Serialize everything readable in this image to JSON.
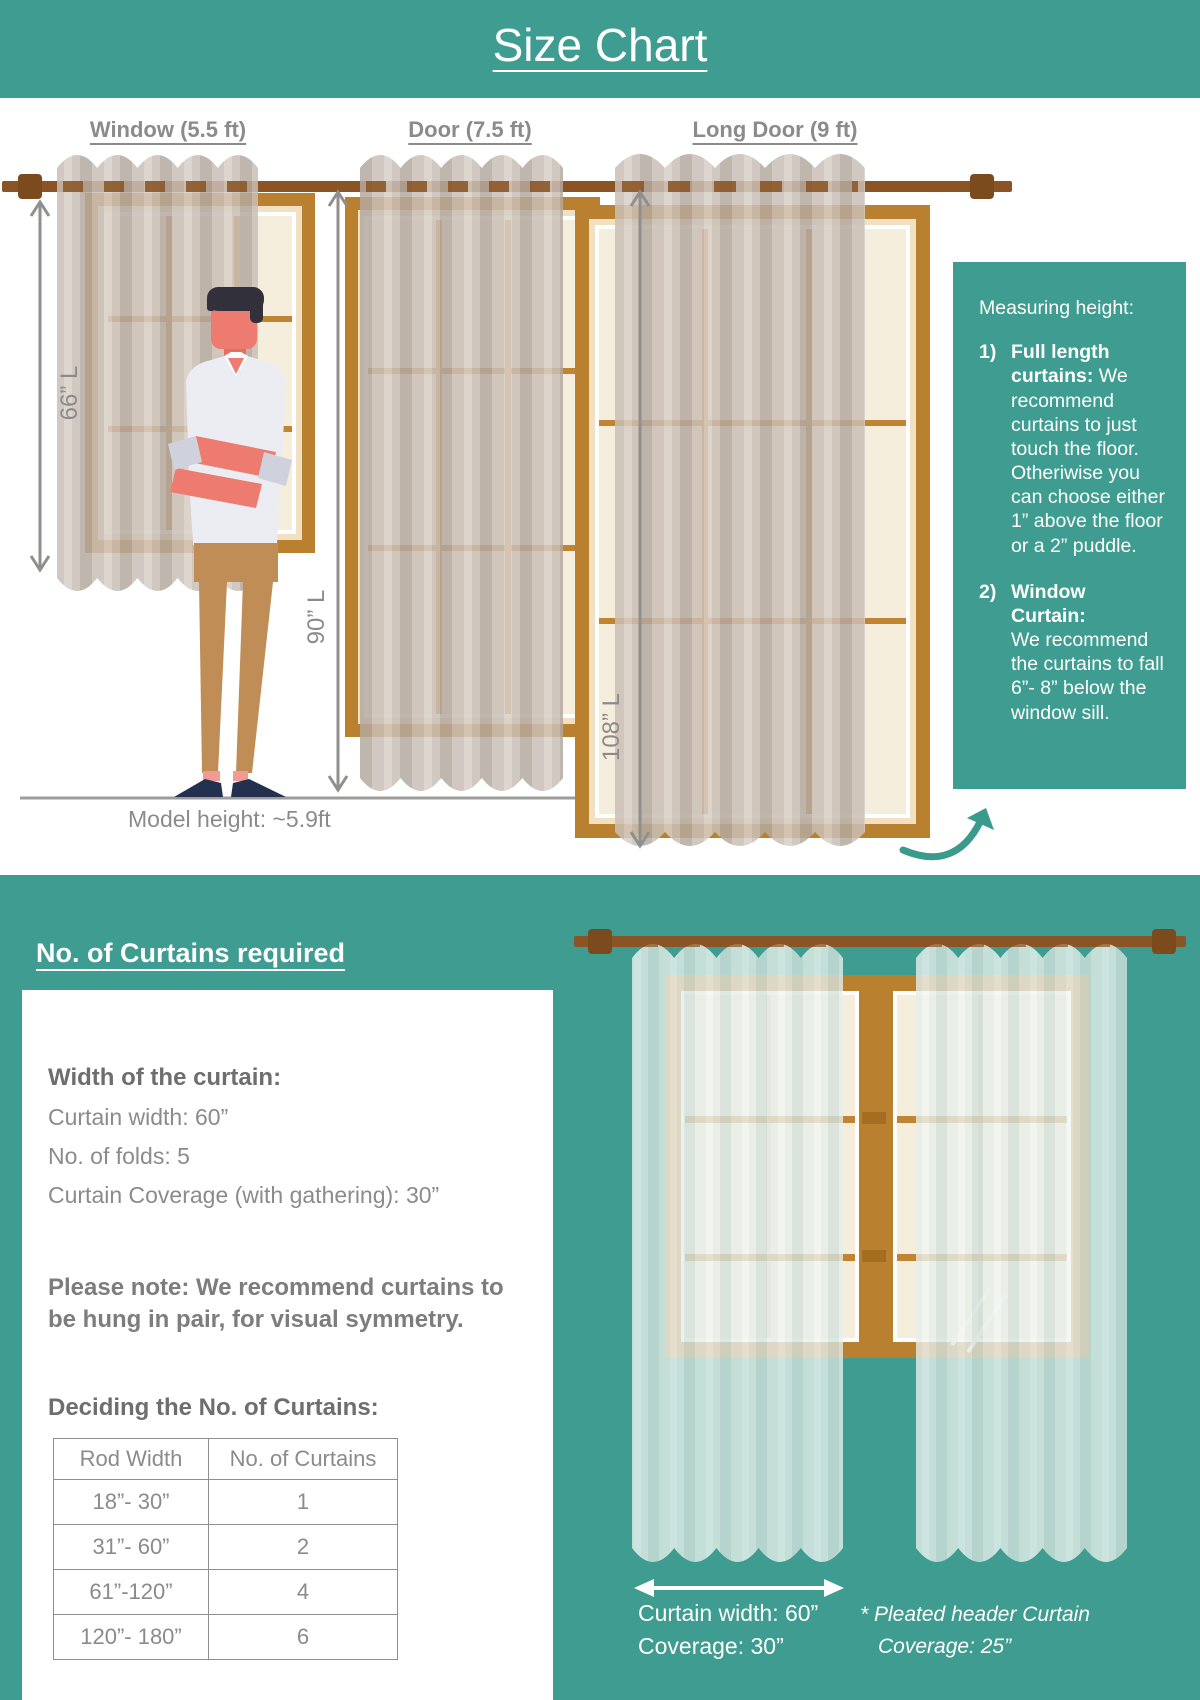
{
  "title": "Size Chart",
  "colors": {
    "teal": "#3e9c91",
    "rod_brown": "#8a5424",
    "frame_brown": "#b9802f",
    "mullion_brown": "#c08433",
    "glass_cream": "#f6eedd",
    "curtain_tan": "#c9bfb6",
    "curtain_pale": "#e6eeea",
    "text_gray": "#8b8b8b",
    "skin": "#ee7b70",
    "shirt": "#ecedf3",
    "pants": "#c08d56",
    "shoes": "#23304f"
  },
  "top_section": {
    "columns": [
      {
        "label": "Window (5.5 ft)",
        "length": "66” L"
      },
      {
        "label": "Door (7.5 ft)",
        "length": "90” L"
      },
      {
        "label": "Long Door (9 ft)",
        "length": "108” L"
      }
    ],
    "model_height": "Model height: ~5.9ft",
    "measuring_box": {
      "heading": "Measuring height:",
      "items": [
        {
          "num": "1)",
          "bold": "Full length curtains:",
          "text": "We recommend curtains to just touch the floor. Otheriwise you can choose either 1” above the floor or a 2” puddle."
        },
        {
          "num": "2)",
          "bold": "Window Curtain:",
          "text": "We recommend the curtains to fall 6”- 8” below the window sill."
        }
      ]
    }
  },
  "bottom_section": {
    "heading": "No. of Curtains required",
    "width_block": {
      "heading": "Width of the curtain:",
      "line1": "Curtain width: 60”",
      "line2": "No. of folds: 5",
      "line3": "Curtain Coverage (with gathering): 30”"
    },
    "note": "Please note: We recommend curtains to be hung in pair, for visual symmetry.",
    "table_heading": "Deciding the No. of Curtains:",
    "table": {
      "headers": [
        "Rod Width",
        "No. of Curtains"
      ],
      "rows": [
        [
          "18”- 30”",
          "1"
        ],
        [
          "31”- 60”",
          "2"
        ],
        [
          "61”-120”",
          "4"
        ],
        [
          "120”- 180”",
          "6"
        ]
      ]
    },
    "curtain_labels": {
      "width_line1": "Curtain width: 60”",
      "width_line2": "Coverage: 30”",
      "pleated_line1": "* Pleated header Curtain",
      "pleated_line2": "Coverage: 25”"
    }
  }
}
